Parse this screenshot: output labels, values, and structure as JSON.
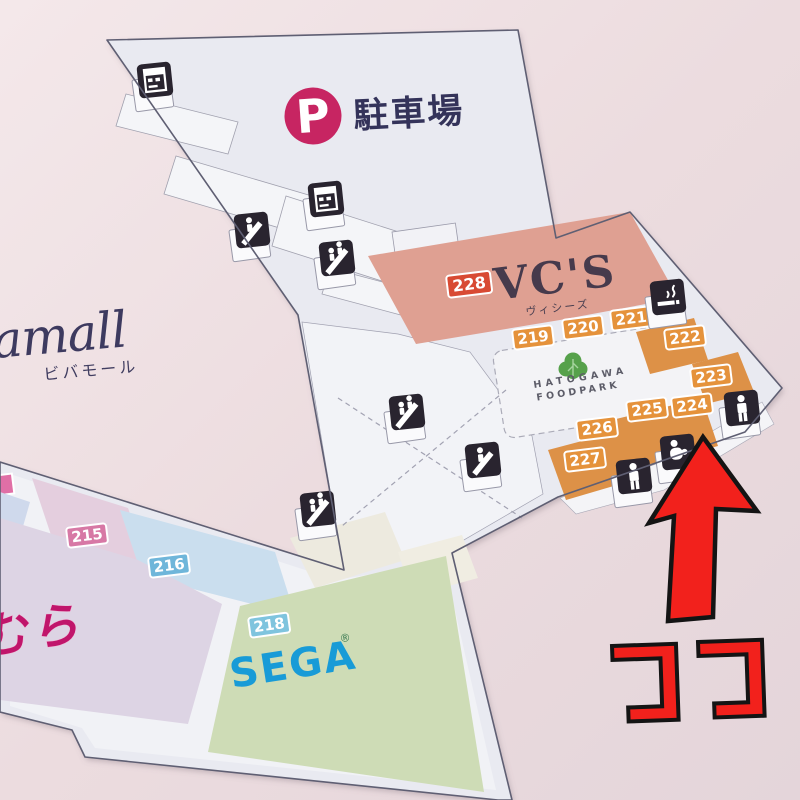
{
  "board": {
    "brand": {
      "name": "amall",
      "kana": "ビバモール"
    },
    "parking": {
      "symbol": "P",
      "label": "駐車場"
    },
    "annotation": {
      "here": "ココ"
    },
    "stores": {
      "vcs": {
        "no": "228",
        "name": "VC'S",
        "kana": "ヴィシーズ"
      },
      "sega": {
        "no": "218",
        "name": "SEGA",
        "reg": "®"
      },
      "foodcourt": {
        "line1": "HATOGAWA",
        "line2": "FOODPARK"
      },
      "left_store": {
        "partial_name": "むら"
      },
      "units": {
        "u215": "215",
        "u216": "216",
        "u219": "219",
        "u220": "220",
        "u221": "221",
        "u222": "222",
        "u223": "223",
        "u224": "224",
        "u225": "225",
        "u226": "226",
        "u227": "227"
      }
    },
    "icons": {
      "vending": "vending-machine",
      "escalator": "escalator",
      "stairs": "stairs",
      "smoking": "smoking-area",
      "restroom": "restroom",
      "baby": "baby-care-room"
    },
    "colors": {
      "arrow_red": "#f2211c",
      "orange_badge": "#e5923b",
      "vcs_fill": "#dfa092",
      "sega_blue": "#189bd7",
      "parking_badge": "#c72562",
      "floor": "#e9eaf1"
    }
  }
}
